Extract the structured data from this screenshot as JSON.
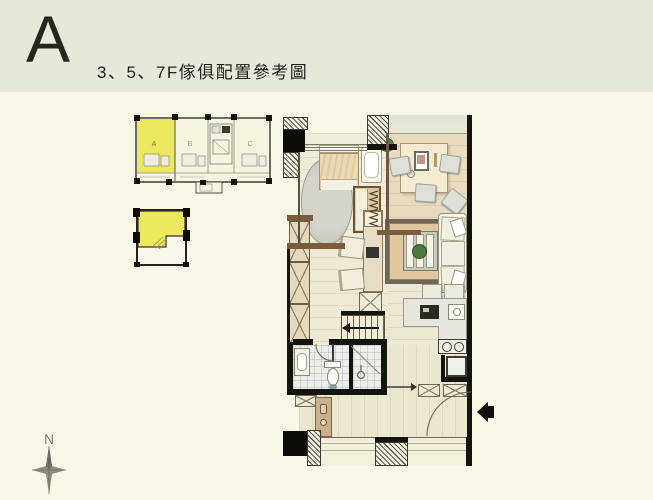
{
  "page": {
    "background": "#f8f6e4"
  },
  "header": {
    "letter": "A",
    "title": "3、5、7F傢俱配置參考圖"
  },
  "key_plan": {
    "units": [
      {
        "label": "A",
        "highlighted": true
      },
      {
        "label": "B",
        "highlighted": false
      },
      {
        "label": "C",
        "highlighted": false
      }
    ]
  },
  "unit_diagram": {
    "note": "unit A outline with highlighted upper zone"
  },
  "compass": {
    "label": "N"
  },
  "icons": {
    "compass_rose": "✦ four-point star",
    "entry_arrow": "◀ solid left-pointing arrow at main entrance"
  },
  "colors": {
    "band": "#e6e9da",
    "page": "#f8f6e4",
    "highlight_yellow": "#ece95f",
    "wall_black": "#15130d",
    "wood_brown": "#7a5c3e"
  }
}
